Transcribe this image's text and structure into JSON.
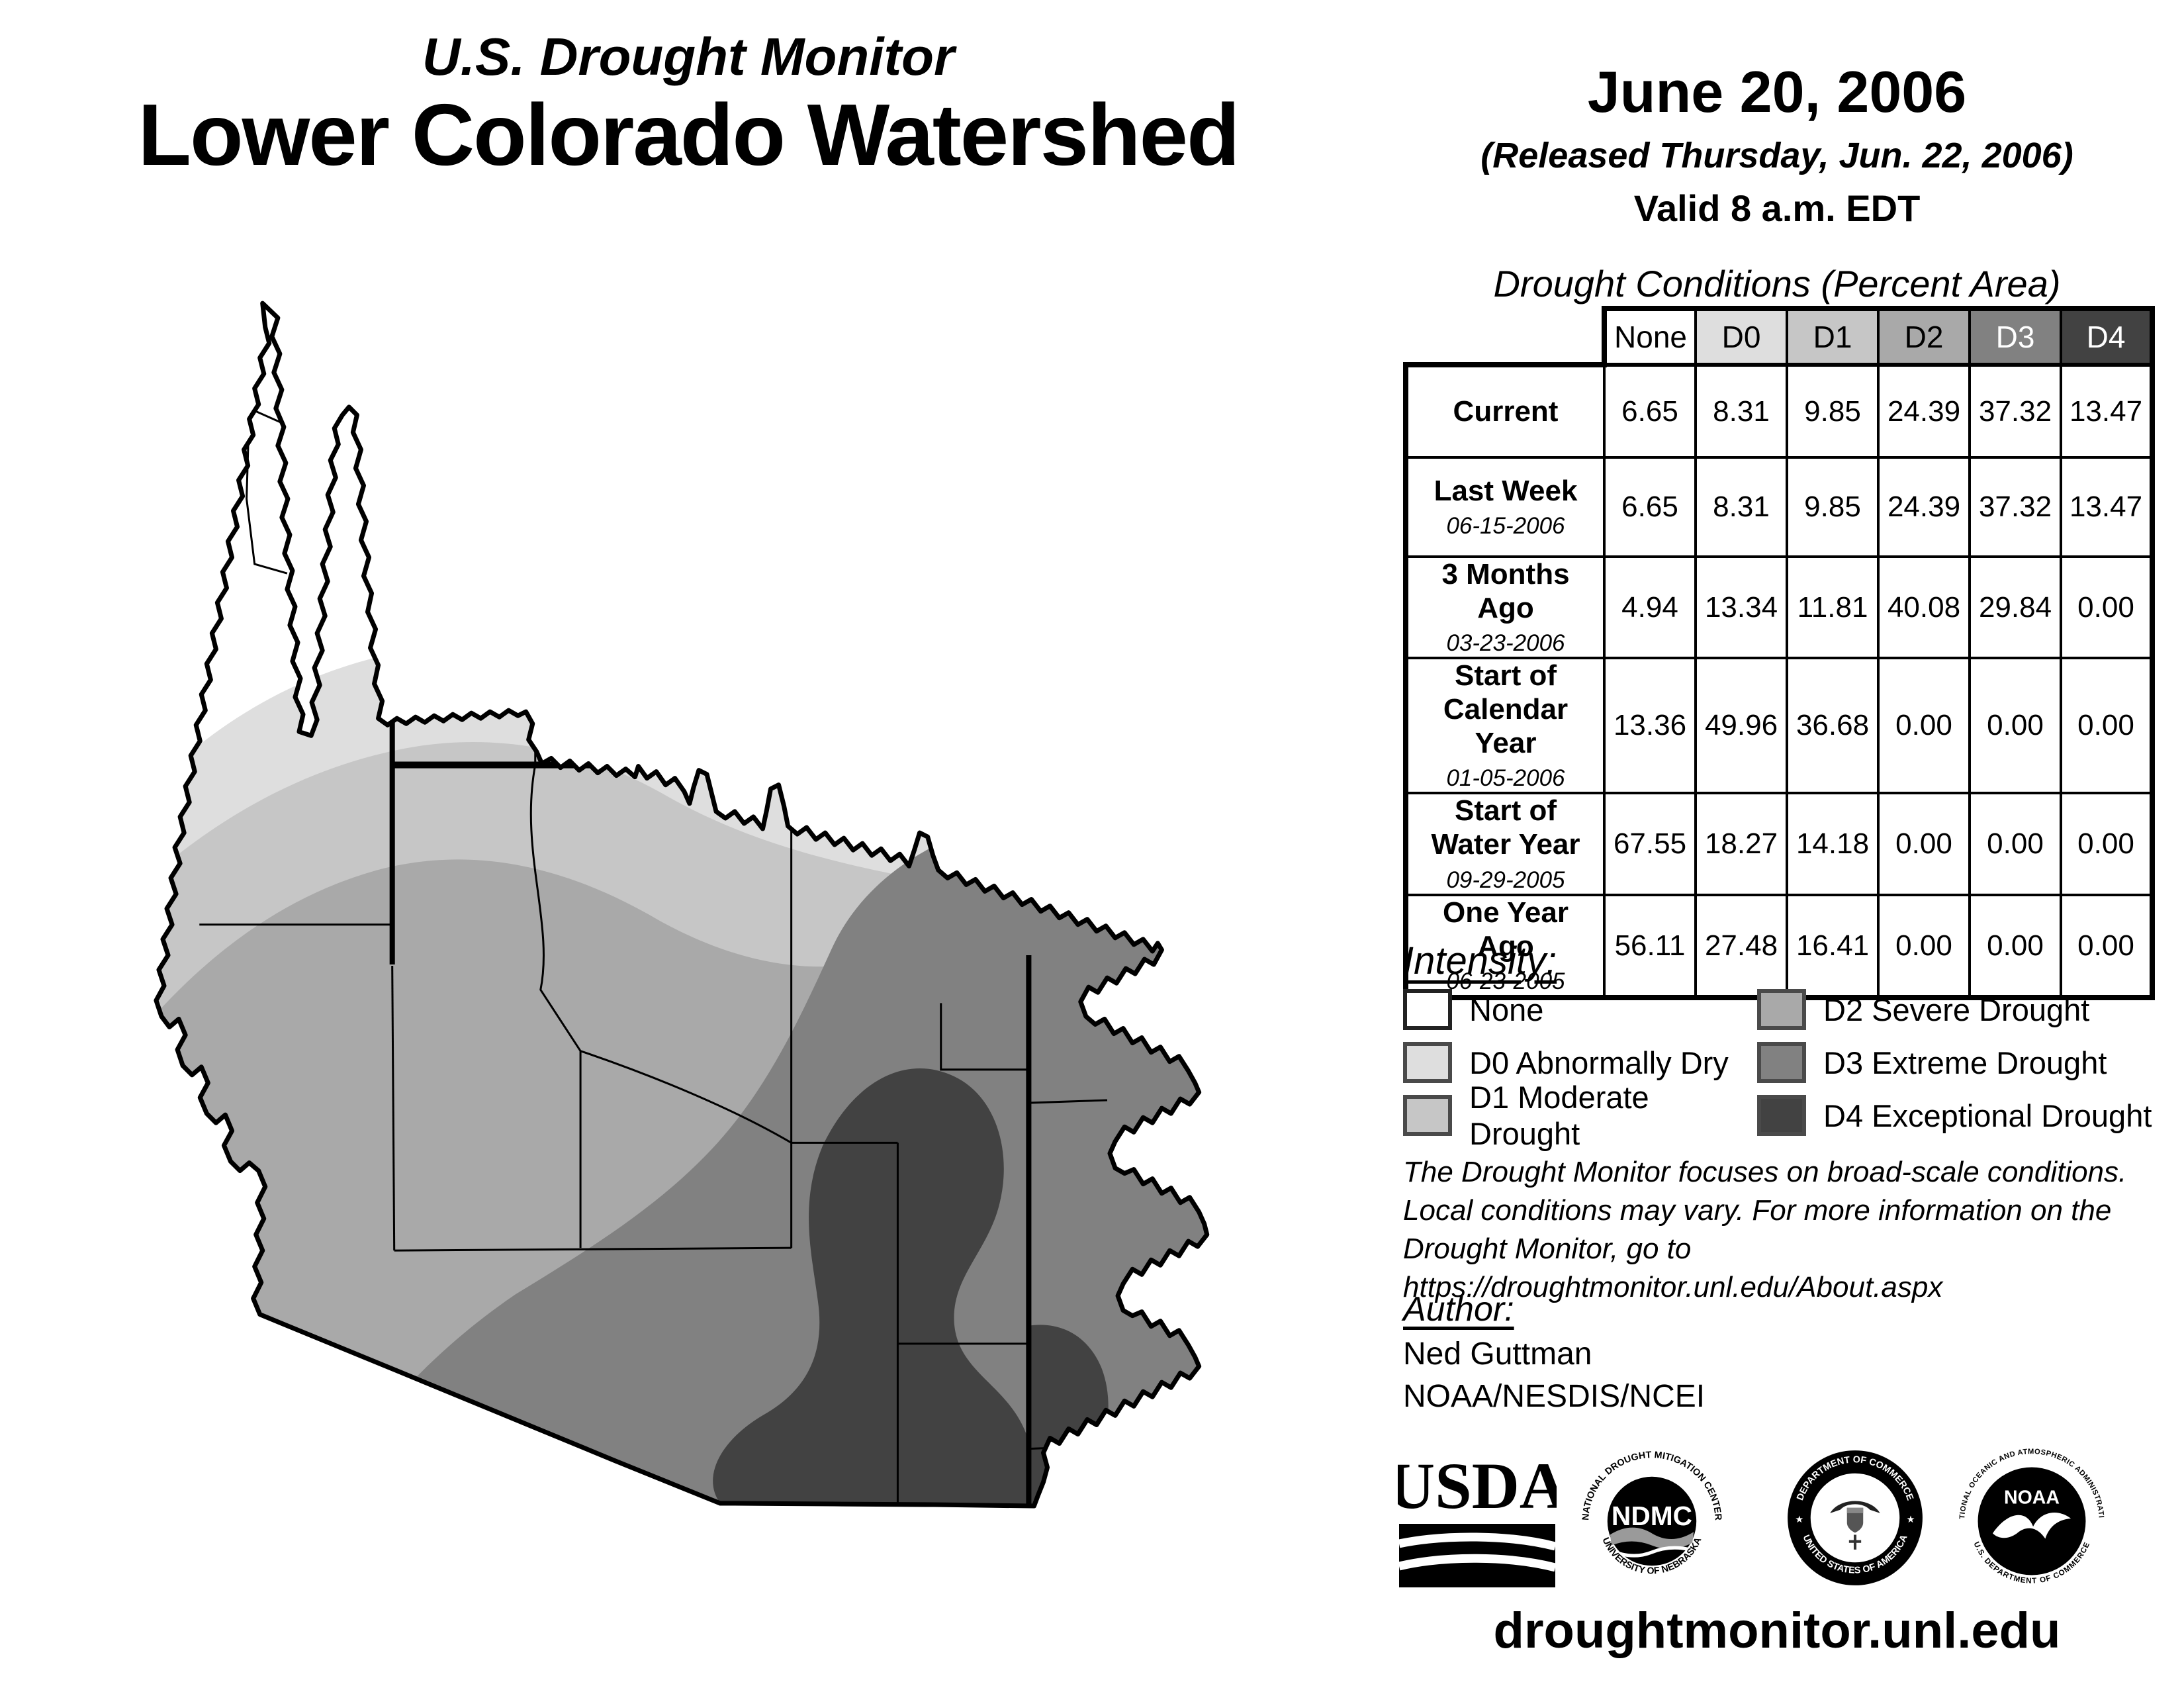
{
  "header": {
    "kicker": "U.S. Drought Monitor",
    "title": "Lower Colorado Watershed"
  },
  "date_block": {
    "date": "June 20, 2006",
    "released": "(Released Thursday, Jun. 22, 2006)",
    "valid": "Valid 8 a.m. EDT"
  },
  "table": {
    "title": "Drought Conditions (Percent Area)",
    "columns": [
      "None",
      "D0",
      "D1",
      "D2",
      "D3",
      "D4"
    ],
    "rows": [
      {
        "label": "Current",
        "date": "",
        "values": [
          "6.65",
          "8.31",
          "9.85",
          "24.39",
          "37.32",
          "13.47"
        ]
      },
      {
        "label": "Last Week",
        "date": "06-15-2006",
        "values": [
          "6.65",
          "8.31",
          "9.85",
          "24.39",
          "37.32",
          "13.47"
        ]
      },
      {
        "label": "3 Months Ago",
        "date": "03-23-2006",
        "values": [
          "4.94",
          "13.34",
          "11.81",
          "40.08",
          "29.84",
          "0.00"
        ]
      },
      {
        "label": "Start of Calendar Year",
        "date": "01-05-2006",
        "values": [
          "13.36",
          "49.96",
          "36.68",
          "0.00",
          "0.00",
          "0.00"
        ]
      },
      {
        "label": "Start of Water Year",
        "date": "09-29-2005",
        "values": [
          "67.55",
          "18.27",
          "14.18",
          "0.00",
          "0.00",
          "0.00"
        ]
      },
      {
        "label": "One Year Ago",
        "date": "06-23-2005",
        "values": [
          "56.11",
          "27.48",
          "16.41",
          "0.00",
          "0.00",
          "0.00"
        ]
      }
    ]
  },
  "legend": {
    "heading": "Intensity:",
    "items": [
      {
        "label": "None",
        "color": "#ffffff"
      },
      {
        "label": "D0 Abnormally Dry",
        "color": "#dedede"
      },
      {
        "label": "D1 Moderate Drought",
        "color": "#c6c6c6"
      },
      {
        "label": "D2 Severe Drought",
        "color": "#a9a9a9"
      },
      {
        "label": "D3 Extreme Drought",
        "color": "#818181"
      },
      {
        "label": "D4 Exceptional Drought",
        "color": "#424242"
      }
    ]
  },
  "disclaimer": "The Drought Monitor focuses on broad-scale conditions.\nLocal conditions may vary. For more information on the\nDrought Monitor, go to https://droughtmonitor.unl.edu/About.aspx",
  "author": {
    "heading": "Author:",
    "name": "Ned Guttman",
    "org": "NOAA/NESDIS/NCEI"
  },
  "logos": {
    "usda": {
      "text": "USDA"
    },
    "ndmc": {
      "center": "NDMC",
      "top": "NATIONAL DROUGHT MITIGATION CENTER",
      "bottom": "UNIVERSITY OF NEBRASKA"
    },
    "doc": {
      "top": "DEPARTMENT OF COMMERCE",
      "bottom": "UNITED STATES OF AMERICA"
    },
    "noaa": {
      "center": "NOAA",
      "top": "NATIONAL OCEANIC AND ATMOSPHERIC ADMINISTRATION",
      "bottom": "U.S. DEPARTMENT OF COMMERCE"
    }
  },
  "footer": {
    "url": "droughtmonitor.unl.edu"
  },
  "colors": {
    "d0": "#dedede",
    "d1": "#c6c6c6",
    "d2": "#a9a9a9",
    "d3": "#818181",
    "d4": "#424242"
  }
}
